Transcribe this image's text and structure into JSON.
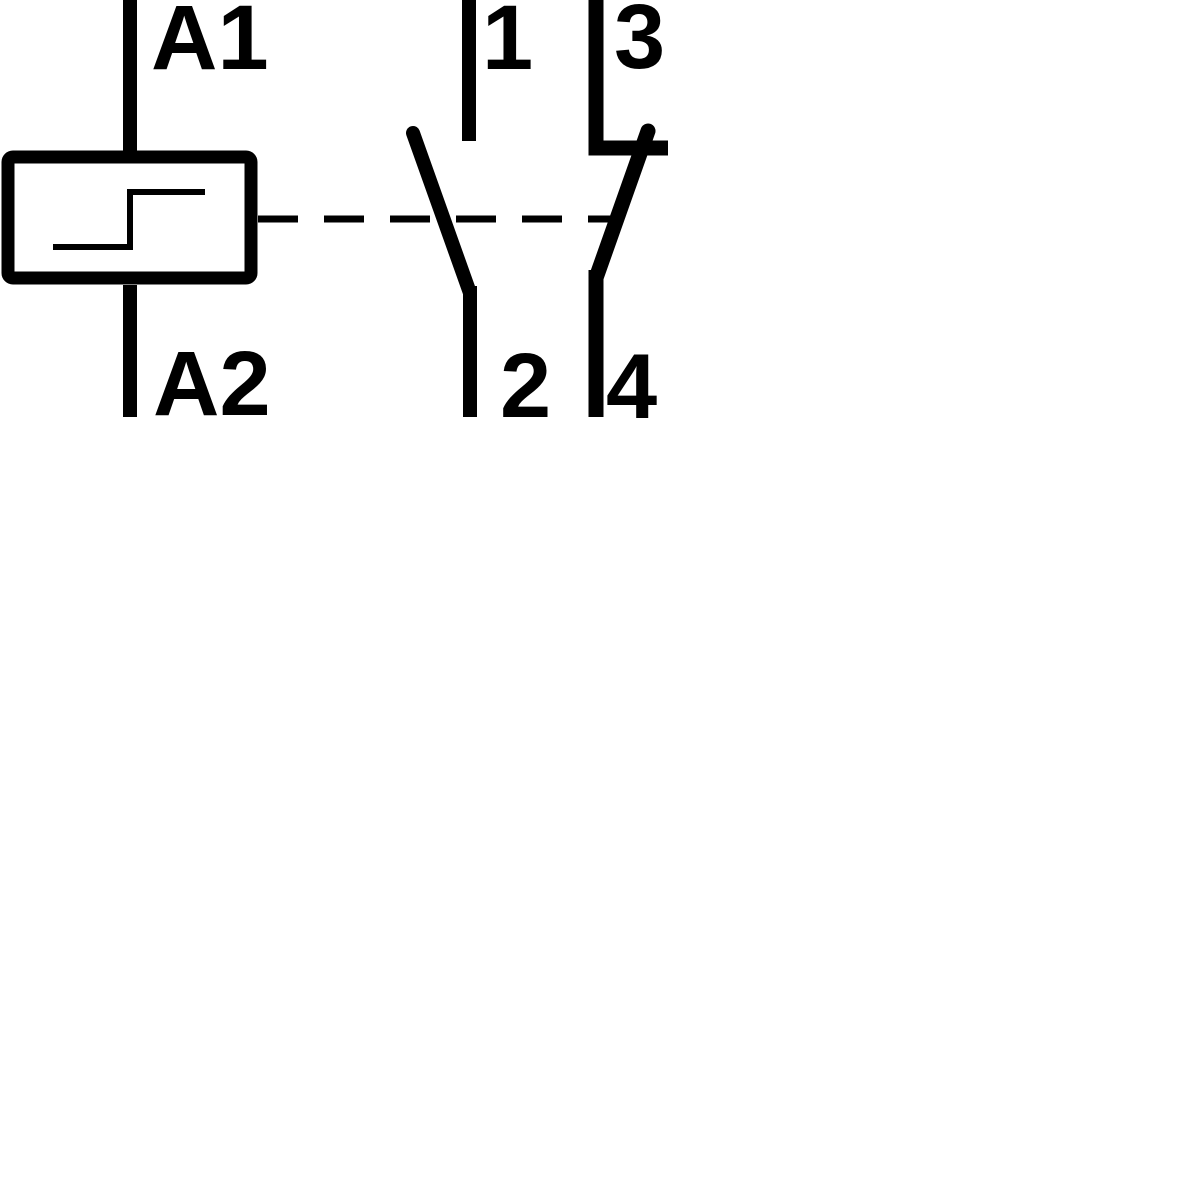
{
  "diagram": {
    "kind": "electrical-wiring-schematic",
    "description": "Latching relay coil with one normally-open contact and one normally-closed contact",
    "colors": {
      "line": "#000000",
      "background": "#ffffff"
    },
    "coil": {
      "symbol": "latching-relay-coil-with-step",
      "terminal_top_label": "A1",
      "terminal_bottom_label": "A2"
    },
    "link": {
      "style": "dashed",
      "meaning": "mechanical-link-between-coil-and-contacts"
    },
    "contacts": [
      {
        "type": "normally-open",
        "terminal_top_label": "1",
        "terminal_bottom_label": "2"
      },
      {
        "type": "normally-closed",
        "terminal_top_label": "3",
        "terminal_bottom_label": "4"
      }
    ]
  }
}
